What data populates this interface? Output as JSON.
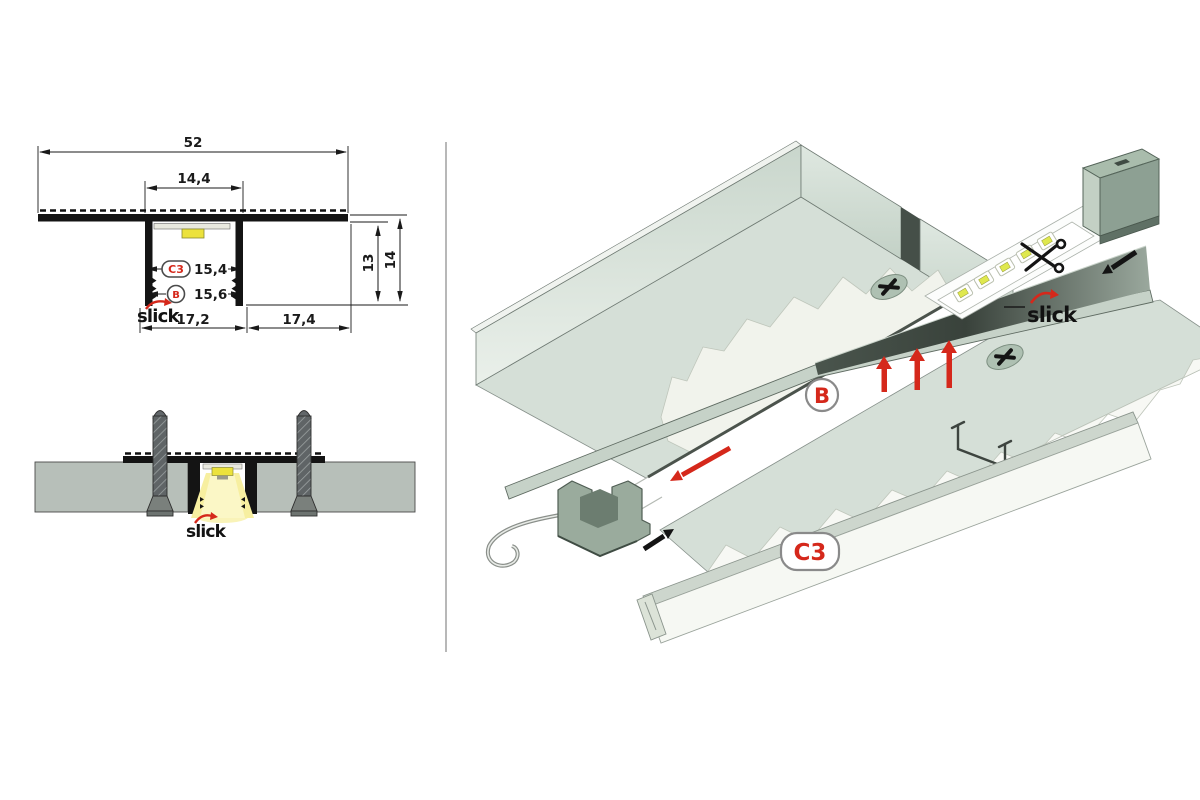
{
  "left_panel": {
    "cross_section": {
      "dims": {
        "overall_width": "52",
        "opening_width": "14,4",
        "cover_width": "15,4",
        "base_width": "15,6",
        "left_flange": "17,2",
        "right_flange": "17,4",
        "inner_depth": "13",
        "outer_depth": "14"
      },
      "badges": {
        "cover": "C3",
        "profile": "B"
      },
      "brand": "slick"
    },
    "installation_section": {
      "brand": "slick"
    }
  },
  "iso_panel": {
    "labels": {
      "profile": "B",
      "cover": "C3",
      "brand": "slick"
    }
  },
  "colors": {
    "accent_red": "#d5281b",
    "brand_black": "#111111",
    "slab_green": "#d5dfd7",
    "plaster_white": "#f1f3ec",
    "profile_dark": "#39423b",
    "aluminum_light": "#c6d2c8",
    "panel_gray": "#b7bfb9",
    "led_yellow": "#ece23c",
    "beam_yellow": "#f7efa0",
    "endcap_green": "#8da093"
  },
  "icons": {
    "scissors-icon": "crossed-blades cut mark",
    "screw-head-icon": "phillips cross oval",
    "insert-up-arrow-icon": "red up arrow",
    "slide-in-arrow-icon": "red diagonal arrow",
    "endcap-mount-arrow-icon": "black diagonal arrow",
    "brand-swoosh-icon": "red curved arrow over logo"
  }
}
